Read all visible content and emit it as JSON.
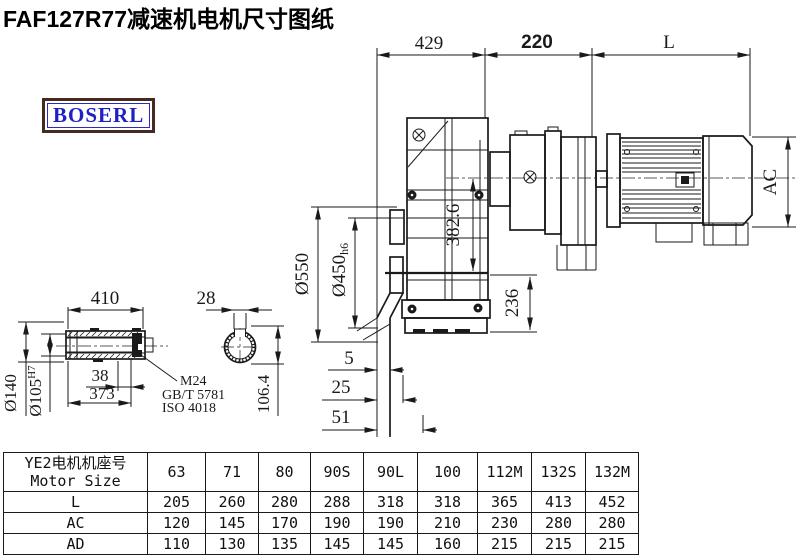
{
  "title": "FAF127R77减速机电机尺寸图纸",
  "logo": "BOSERL",
  "dimensions": {
    "top_429": "429",
    "top_220": "220",
    "top_L": "L",
    "phi550": "Ø550",
    "phi450": "Ø450",
    "phi450_tol": "h6",
    "d382": "382.6",
    "d236": "236",
    "ac": "AC",
    "d5": "5",
    "d25": "25",
    "d51": "51"
  },
  "shaft_detail": {
    "d410": "410",
    "d28": "28",
    "phi140": "Ø140",
    "phi105": "Ø105",
    "phi105_tol": "H7",
    "d38": "38",
    "d373": "373",
    "d106": "106.4",
    "thread": "M24",
    "standard1": "GB/T 5781",
    "standard2": "ISO 4018"
  },
  "table": {
    "header_cn": "YE2电机机座号",
    "header_en": "Motor Size",
    "sizes": [
      "63",
      "71",
      "80",
      "90S",
      "90L",
      "100",
      "112M",
      "132S",
      "132M"
    ],
    "rows": [
      {
        "label": "L",
        "values": [
          "205",
          "260",
          "280",
          "288",
          "318",
          "318",
          "365",
          "413",
          "452"
        ]
      },
      {
        "label": "AC",
        "values": [
          "120",
          "145",
          "170",
          "190",
          "190",
          "210",
          "230",
          "280",
          "280"
        ]
      },
      {
        "label": "AD",
        "values": [
          "110",
          "130",
          "135",
          "145",
          "145",
          "160",
          "215",
          "215",
          "215"
        ]
      }
    ]
  }
}
